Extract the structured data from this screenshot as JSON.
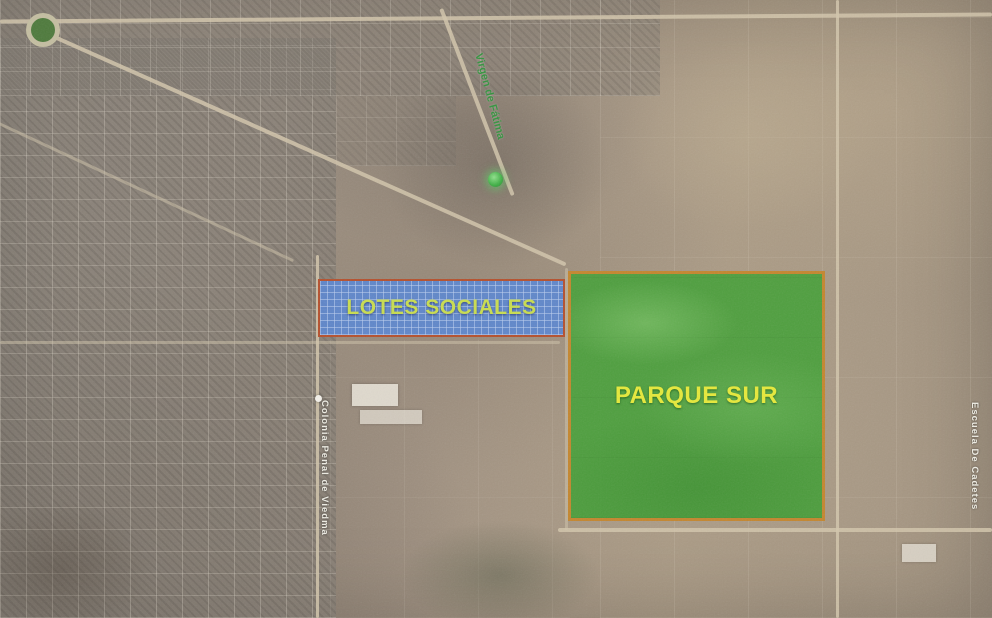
{
  "map": {
    "kind": "satellite-aerial",
    "region_overlays": [
      {
        "id": "lotes_sociales",
        "label": "LOTES SOCIALES",
        "fill_color": "#5b87d0",
        "pattern": "grid-hatch",
        "border_color": "#b5502d",
        "label_color": "#c9dd4f"
      },
      {
        "id": "parque_sur",
        "label": "PARQUE SUR",
        "fill_color": "#48a03a",
        "pattern": "solid",
        "border_color": "#c4862e",
        "label_color": "#e6e93a"
      }
    ],
    "road_labels": [
      {
        "id": "virgen_de_fatima",
        "text": "Virgen de Fátima",
        "color": "#35933f",
        "orientation": "diagonal"
      },
      {
        "id": "colonia_penal",
        "text": "Colonia Penal de Viedma",
        "color": "#f2efe8",
        "orientation": "vertical"
      },
      {
        "id": "escuela_de_cadetes",
        "text": "Escuela De Cadetes",
        "color": "#f2efe8",
        "orientation": "vertical"
      }
    ],
    "markers": [
      {
        "id": "green_place_marker",
        "color": "#4fc057"
      },
      {
        "id": "white_place_marker",
        "color": "#f4f1ea"
      }
    ],
    "terrain_colors": {
      "base_brown": "#a09181",
      "urban_gray": "#8a837a",
      "field_tan": "#b3a38c",
      "road": "#d2c5ac"
    }
  }
}
